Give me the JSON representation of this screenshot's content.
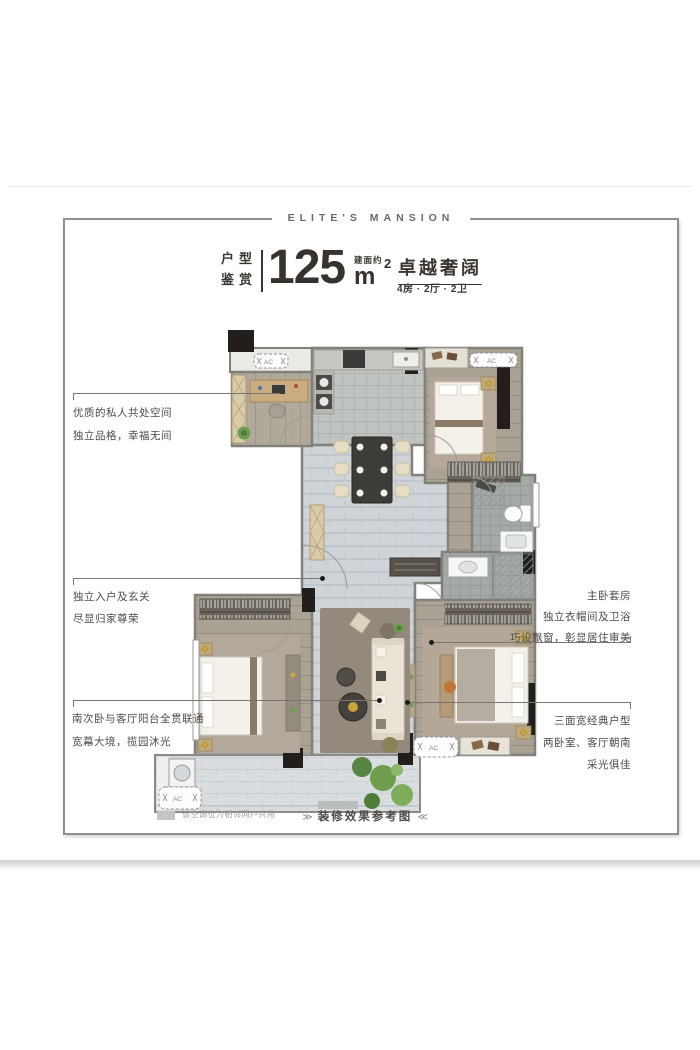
{
  "brand": "ELITE'S MANSION",
  "header": {
    "category_line1": "户型",
    "category_line2": "鉴赏",
    "area_number": "125",
    "area_note": "建面约",
    "area_unit": "m",
    "area_sup": "2",
    "headline": "卓越奢阔",
    "spec": "4房 · 2厅 · 2卫"
  },
  "annotations": {
    "left": [
      {
        "lines": [
          "优质的私人共处空间",
          "独立品格，幸福无间"
        ]
      },
      {
        "lines": [
          "独立入户及玄关",
          "尽显归家尊荣"
        ]
      },
      {
        "lines": [
          "南次卧与客厅阳台全贯联通",
          "宽幕大境，揽园沐光"
        ]
      }
    ],
    "right": [
      {
        "lines": [
          "主卧套房",
          "独立衣帽间及卫浴",
          "巧设飘窗，彰显居住审美"
        ]
      },
      {
        "lines": [
          "三面宽经典户型",
          "两卧室、客厅朝南",
          "采光俱佳"
        ]
      }
    ]
  },
  "footer": {
    "legend_note": "该空调位为相邻两户共用",
    "caption": "装修效果参考图",
    "caption_prefix": "≫",
    "caption_suffix": "≪"
  },
  "floorplan": {
    "ac_label": "AC"
  },
  "colors": {
    "ink": "#3b352f",
    "annotation_text": "#4f4a44",
    "wall_gray": "#82807b",
    "wall_black": "#211e1b",
    "marble_floor": "#ced4d8",
    "wood_floor": "#aaa295",
    "gold_accent": "#cfa93d",
    "plant_green": "#6f9e4f"
  }
}
